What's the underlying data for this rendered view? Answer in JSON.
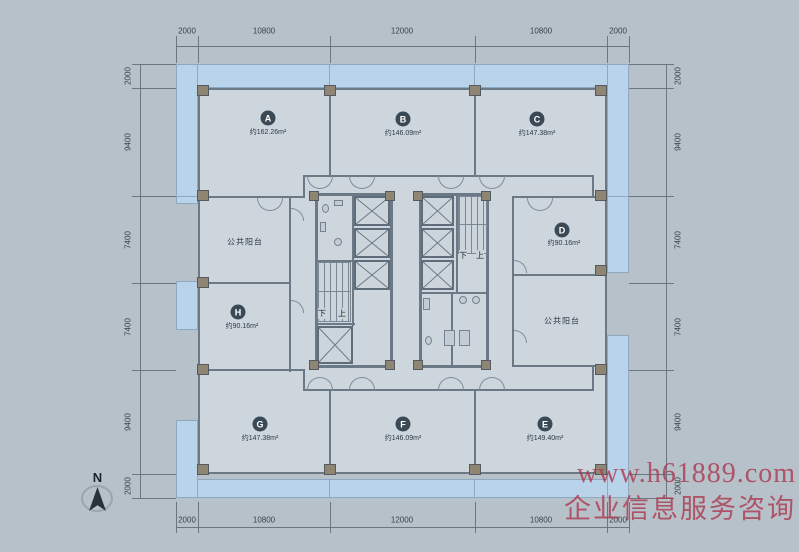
{
  "plan": {
    "rooms": [
      {
        "letter": "A",
        "area": "约162.26m²"
      },
      {
        "letter": "B",
        "area": "约146.09m²"
      },
      {
        "letter": "C",
        "area": "约147.38m²"
      },
      {
        "letter": "D",
        "area": "约90.16m²"
      },
      {
        "letter": "E",
        "area": "约149.40m²"
      },
      {
        "letter": "F",
        "area": "约146.09m²"
      },
      {
        "letter": "G",
        "area": "约147.38m²"
      },
      {
        "letter": "H",
        "area": "约90.16m²"
      }
    ],
    "balcony_label": "公共阳台",
    "stairs": {
      "down": "下",
      "up": "上"
    },
    "north": "N"
  },
  "dimensions": {
    "top": [
      "2000",
      "10800",
      "12000",
      "10800",
      "2000"
    ],
    "bottom": [
      "2000",
      "10800",
      "12000",
      "10800",
      "2000"
    ],
    "left": [
      "2000",
      "9400",
      "7400",
      "7400",
      "9400",
      "2000"
    ],
    "right": [
      "2000",
      "9400",
      "7400",
      "7400",
      "9400",
      "2000"
    ]
  },
  "watermark": {
    "line1": "www.h61889.com",
    "line2": "企业信息服务咨询"
  },
  "colors": {
    "band": "#b9d4ea",
    "wall": "#6b7987",
    "room_fill": "#cdd6dd",
    "column": "#8e8573",
    "label_circle": "#3a4956",
    "watermark": "#ab3c50"
  }
}
